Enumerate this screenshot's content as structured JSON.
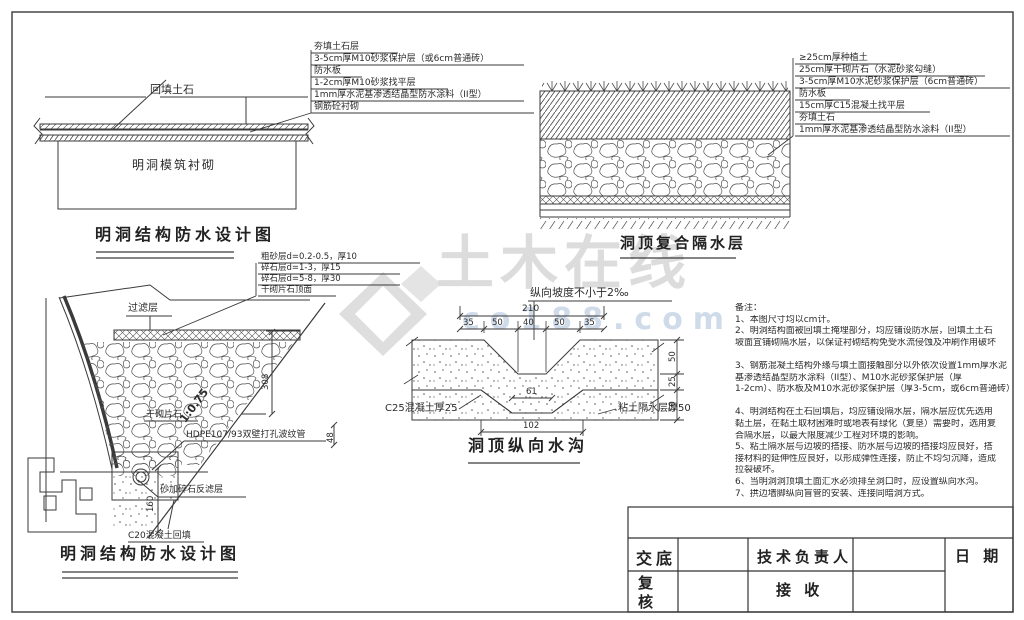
{
  "watermark": {
    "brand": "土木在线",
    "site": "co188.com"
  },
  "d1": {
    "title": "明洞结构防水设计图",
    "fill_label": "回填土石",
    "lining_label": "明洞模筑衬砌",
    "layers": [
      "夯填土石层",
      "3-5cm厚M10砂浆保护层（或6cm普通砖）",
      "防水板",
      "1-2cm厚M10砂浆找平层",
      "1mm厚水泥基渗透结晶型防水涂料（II型）",
      "钢筋砼衬砌"
    ]
  },
  "d2": {
    "title": "洞顶复合隔水层",
    "layers": [
      "≥25cm厚种植土",
      "25cm厚干砌片石（水泥砂浆勾缝）",
      "3-5cm厚M10水泥砂浆保护层（6cm普通砖）",
      "防水板",
      "15cm厚C15混凝土找平层",
      "夯填土石",
      "1mm厚水泥基渗透结晶型防水涂料（II型）"
    ]
  },
  "gravel": {
    "items": [
      "粗砂层d=0.2-0.5，厚10",
      "碎石层d=1-3，厚15",
      "碎石层d=5-8，厚30",
      "干砌片石顶面"
    ]
  },
  "d3": {
    "title": "明洞结构防水设计图",
    "filter": "过滤层",
    "drystone": "干砌片石",
    "slope": "1:0.75",
    "hdpe": "HDPE107/93双壁打孔波纹管",
    "sand_filter": "砂加碎石反滤层",
    "c20": "C20混凝土回填",
    "dims": {
      "height": "308",
      "foot": "160",
      "pipe": "48"
    }
  },
  "d4": {
    "title": "洞顶纵向水沟",
    "slope_note": "纵向坡度不小于2‰",
    "c25": "C25混凝土厚25",
    "clay": "粘土隔水层厚50",
    "dims": {
      "total": "210",
      "segs": [
        "35",
        "50",
        "40",
        "50",
        "35"
      ],
      "right": [
        "50",
        "25",
        "50"
      ],
      "inner": "61",
      "bottom": "102"
    }
  },
  "notes": {
    "lines": [
      "备注：",
      "1、本图尺寸均以cm计。",
      "2、明洞结构面被回填土掩埋部分，均应铺设防水层，回填土土石",
      "坡面宜铺砌隔水层，以保证衬砌结构免受水流侵蚀及冲刷作用破坏",
      "",
      "3、钢筋混凝土结构外缘与填土面接触部分以外依次设置1mm厚水泥",
      "基渗透结晶型防水涂料（II型）、M10水泥砂浆保护层（厚",
      "1-2cm）、防水板及M10水泥砂浆保护层（厚3-5cm，或6cm普通砖）",
      "",
      "4、明洞结构在土石回填后，均应铺设隔水层，隔水层应优先选用",
      "黏土层，在黏土取材困难时或地表有绿化（复垦）需要时，选用复",
      "合隔水层，以最大限度减少工程对环境的影响。",
      "5、粘土隔水层与边坡的搭接、防水层与边坡的搭接均应良好，搭",
      "接材料的延伸性应良好，以形成弹性连接，防止不均匀沉降，造成",
      "拉裂破坏。",
      "6、当明洞洞顶填土面汇水必须排至洞口时，应设置纵向水沟。",
      "7、拱边墙脚纵向盲管的安装、连接同暗洞方式。"
    ]
  },
  "titleblock": {
    "jiaodi": "交底",
    "fuhe": "复核",
    "tech": "技术负责人",
    "jieshou": "接 收",
    "date": "日 期"
  }
}
